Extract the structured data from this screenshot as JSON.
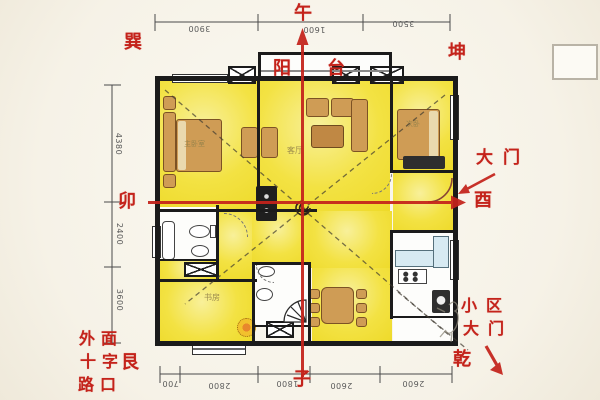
{
  "title": "apartment feng shui floor plan",
  "colors": {
    "annotation_red": "#c4231b",
    "room_yellow": "#f3e243",
    "furniture_tan": "#cf9c55",
    "counter_blue": "#d7eaf2",
    "wall_black": "#1b1b1b",
    "paper": "#f6f2e7"
  },
  "compass": {
    "top": "午",
    "bottom": "子",
    "left": "卯",
    "right": "酉",
    "top_left": "巽",
    "top_right": "坤",
    "bottom_left": "艮",
    "bottom_right": "乾"
  },
  "annotations": {
    "balcony_char1": "阳",
    "balcony_char2": "台",
    "main_door": "大门",
    "community_gate_row1": "小区",
    "community_gate_row2": "大门",
    "crossroads_row1": "外面",
    "crossroads_row2": "十字",
    "crossroads_row3": "路口"
  },
  "room_labels": {
    "master_bedroom": "主卧室",
    "living_room": "客厅",
    "second_bedroom": "次卧",
    "study": "书房"
  },
  "dimensions": {
    "top": [
      "3900",
      "1600",
      "3500"
    ],
    "left": [
      "4380",
      "2400",
      "3600"
    ],
    "bottom": [
      "700",
      "2800",
      "1800",
      "2600",
      "2600"
    ]
  }
}
